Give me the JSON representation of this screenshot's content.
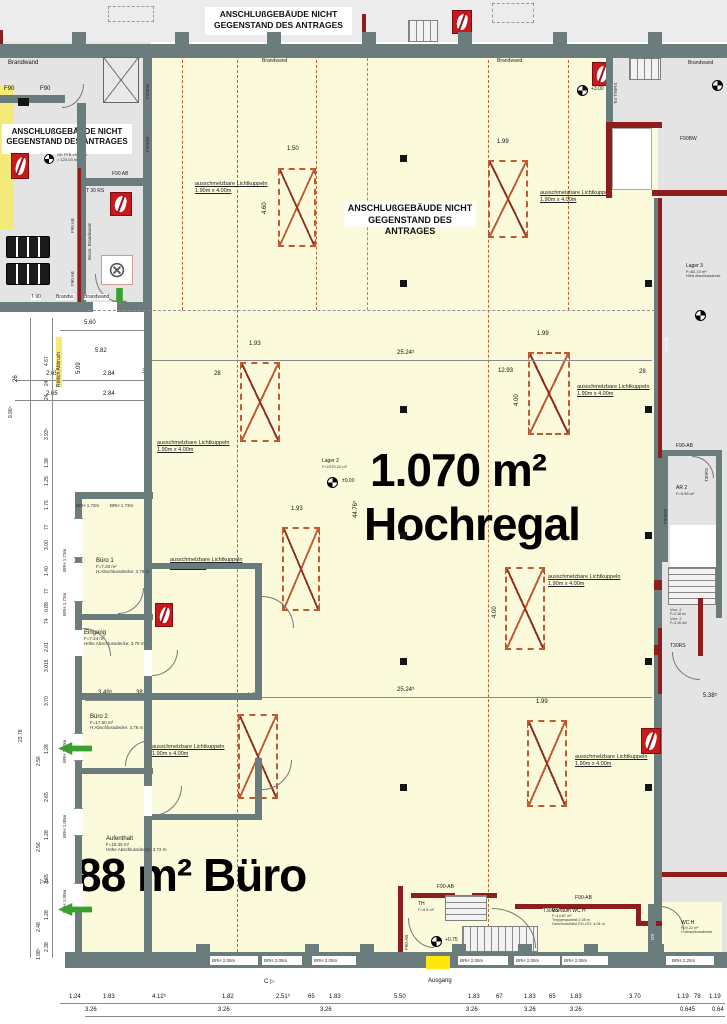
{
  "banner": {
    "line1": "ANSCHLUßGEBÄUDE NICHT",
    "line2": "GEGENSTAND DES ANTRAGES"
  },
  "big": {
    "area": "1.070 m²",
    "name": "Hochregal",
    "office": "88 m² Büro"
  },
  "sky": {
    "l1": "ausschmelzbare Lichtkuppeln",
    "l2": "1.90m x 4.00m"
  },
  "labels": {
    "brandwand": "Brandwand",
    "brandw": "Brandw.",
    "besst": "Besst. Brandwand",
    "t90": "T 90",
    "t30rs": "T 30 RS",
    "t30rs2": "T30RS",
    "tor": "Tor T90RS",
    "f90": "F90",
    "f90ab": "F90-AB",
    "f90ab2": "F90 AB",
    "f90bw": "F90BW",
    "f90w": "F90-W",
    "ausgang": "Ausgang",
    "roetlich": "Rötlich Abbruch",
    "okffb1": "OK FFB ±0.00 m",
    "okffb2": "= 123.03 m",
    "ds": "DS"
  },
  "levels": {
    "p0": "±0.00",
    "p3": "+3.00",
    "p075": "+0.75"
  },
  "brh": {
    "b173": "BRH 1.73m",
    "b100": "BRH 1.00m",
    "b205": "BRH 2.05m",
    "b225": "BRH 2.25m"
  },
  "sec": {
    "a": "A",
    "c": "C",
    "tri": "▷"
  },
  "rooms": {
    "lager2": {
      "name": "Lager 2",
      "area": "F=1070.22 m²"
    },
    "lager3": {
      "name": "Lager 3",
      "area": "F=82.10 m²",
      "note": "Höhe Abschlussdecke"
    },
    "buero1": {
      "name": "Büro 1",
      "area": "F=7.33 m²",
      "note": "H:Abschlussdecke: 3.79 m"
    },
    "eingang": {
      "name": "Eingang",
      "area": "F=7.24 m²",
      "note": "Höhe Abschlussdecke: 3.79 m"
    },
    "buero2": {
      "name": "Büro 2",
      "area": "F=17.60 m²",
      "note": "H:Abschlussdecke: 3.76 m"
    },
    "aufenthalt": {
      "name": "Aufenthalt",
      "area": "F=18.36 m²",
      "note": "Höhe Abschlussdecke: 3.72 m"
    },
    "th": {
      "name": "TH",
      "area": "F=4.5 m²"
    },
    "vorraum": {
      "name": "Vorraum WC H",
      "area": "F=14.87 m²",
      "note1": "Treppenpodest 2.35 m",
      "note2": "Geschosshöhe EG-OG: 4.04 m"
    },
    "wch": {
      "name": "WC H",
      "area": "F=9.22 m²",
      "note": "H:Abschlussdecke"
    },
    "ar2": {
      "name": "AR 2",
      "area": "F=9.98 m²"
    },
    "vorr2": {
      "name": "Vorr. 2",
      "area": "F=3.18 m²",
      "name2": "Vorr. 2",
      "area2": "F=3.16 m2"
    }
  },
  "dims": {
    "b1": [
      "1.24",
      "1.83",
      "4.12⁵",
      "1.82",
      "2.51⁵",
      "65",
      "1.83",
      "5.50",
      "1.83",
      "67",
      "1.83",
      "65",
      "1.83",
      "3.70",
      "1.19",
      "78",
      "1.19"
    ],
    "b2": [
      "3.26",
      "3.26",
      "3.26",
      "3.26",
      "3.26",
      "3.26",
      "0.645",
      "0.64"
    ],
    "lt": [
      "4.67",
      "24",
      "24",
      "3.93⁵",
      "1.38",
      "1.25",
      "1.76",
      "77",
      "3.00",
      "1.40",
      "77",
      "0.89",
      "74",
      "2.01",
      "3.015"
    ],
    "lb": [
      "3.70",
      "1.28",
      "2.56",
      "2.65",
      "1.28",
      "2.56",
      "2.65",
      "1.28",
      "2.48",
      "2.38",
      "1.98⁵"
    ],
    "ov1": "9.96⁵",
    "ov2": "23.78",
    "d560": "5.60",
    "d582": "5.82",
    "d509": "5.09",
    "d265": "2.65",
    "d284": "2.84",
    "d26": "26",
    "d38": "38",
    "d2524": "25.24⁵",
    "d4476": "44.76⁵",
    "d1293": "12.93",
    "d28": "28",
    "d349": "3.49⁵",
    "d538": "5.38⁵",
    "s150": "1.50",
    "s199": "1.99",
    "s193": "1.93",
    "d400": "4.00",
    "d460": "4.60"
  }
}
